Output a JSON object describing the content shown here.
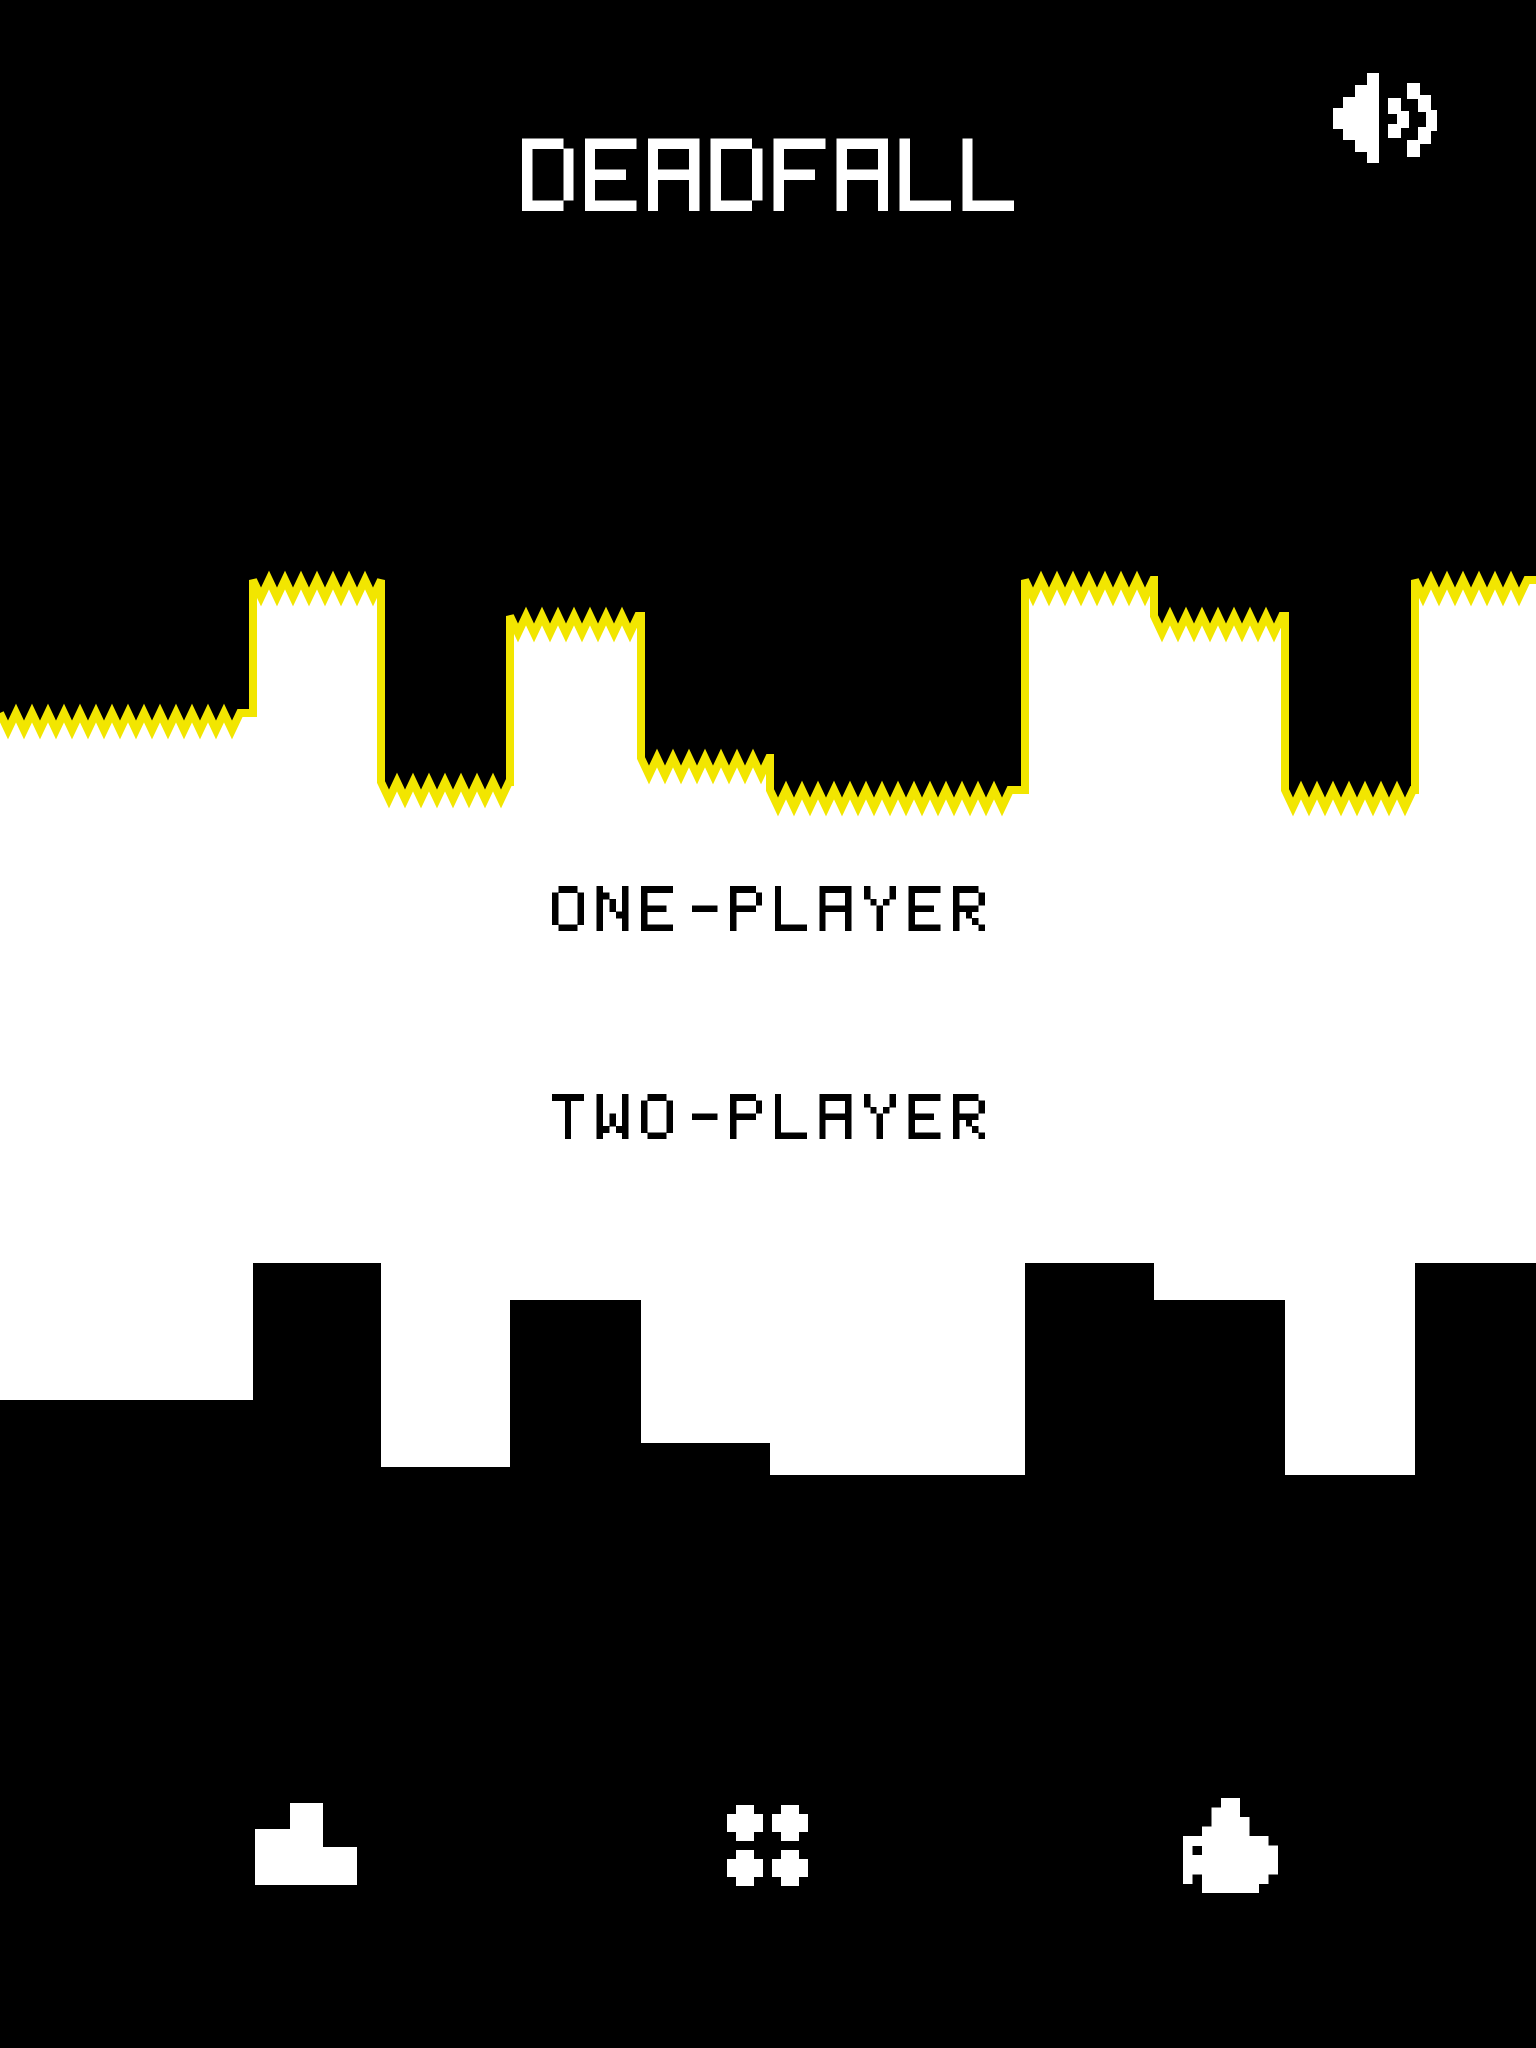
{
  "app": {
    "title": "DEADFALL"
  },
  "header": {
    "sound_button": {
      "icon": "speaker-sound-on-icon"
    }
  },
  "menu": {
    "items": [
      {
        "id": "one-player",
        "label": "ONE-PLAYER"
      },
      {
        "id": "two-player",
        "label": "TWO-PLAYER"
      }
    ]
  },
  "footer": {
    "buttons": [
      {
        "icon": "podium-icon"
      },
      {
        "icon": "dots-grid-icon"
      },
      {
        "icon": "thumbs-up-icon"
      }
    ]
  },
  "colors": {
    "background": "#000000",
    "ground": "#ffffff",
    "terrain_trim": "#f2e600",
    "title_text": "#ffffff",
    "menu_text": "#000000",
    "icon": "#ffffff"
  },
  "terrain": {
    "tooth_width": 16,
    "tooth_depth": 17,
    "trim_stroke": 8,
    "upper_profile": [
      [
        0,
        253,
        713
      ],
      [
        253,
        381,
        580
      ],
      [
        381,
        510,
        782
      ],
      [
        510,
        641,
        616
      ],
      [
        641,
        770,
        758
      ],
      [
        770,
        1025,
        790
      ],
      [
        1025,
        1154,
        580
      ],
      [
        1154,
        1285,
        616
      ],
      [
        1285,
        1415,
        790
      ],
      [
        1415,
        1536,
        580
      ]
    ],
    "lower_profile": [
      [
        0,
        253,
        1400
      ],
      [
        253,
        381,
        1263
      ],
      [
        381,
        510,
        1467
      ],
      [
        510,
        641,
        1300
      ],
      [
        641,
        770,
        1443
      ],
      [
        770,
        1025,
        1475
      ],
      [
        1025,
        1154,
        1263
      ],
      [
        1154,
        1285,
        1300
      ],
      [
        1285,
        1415,
        1475
      ],
      [
        1415,
        1536,
        1263
      ]
    ]
  }
}
